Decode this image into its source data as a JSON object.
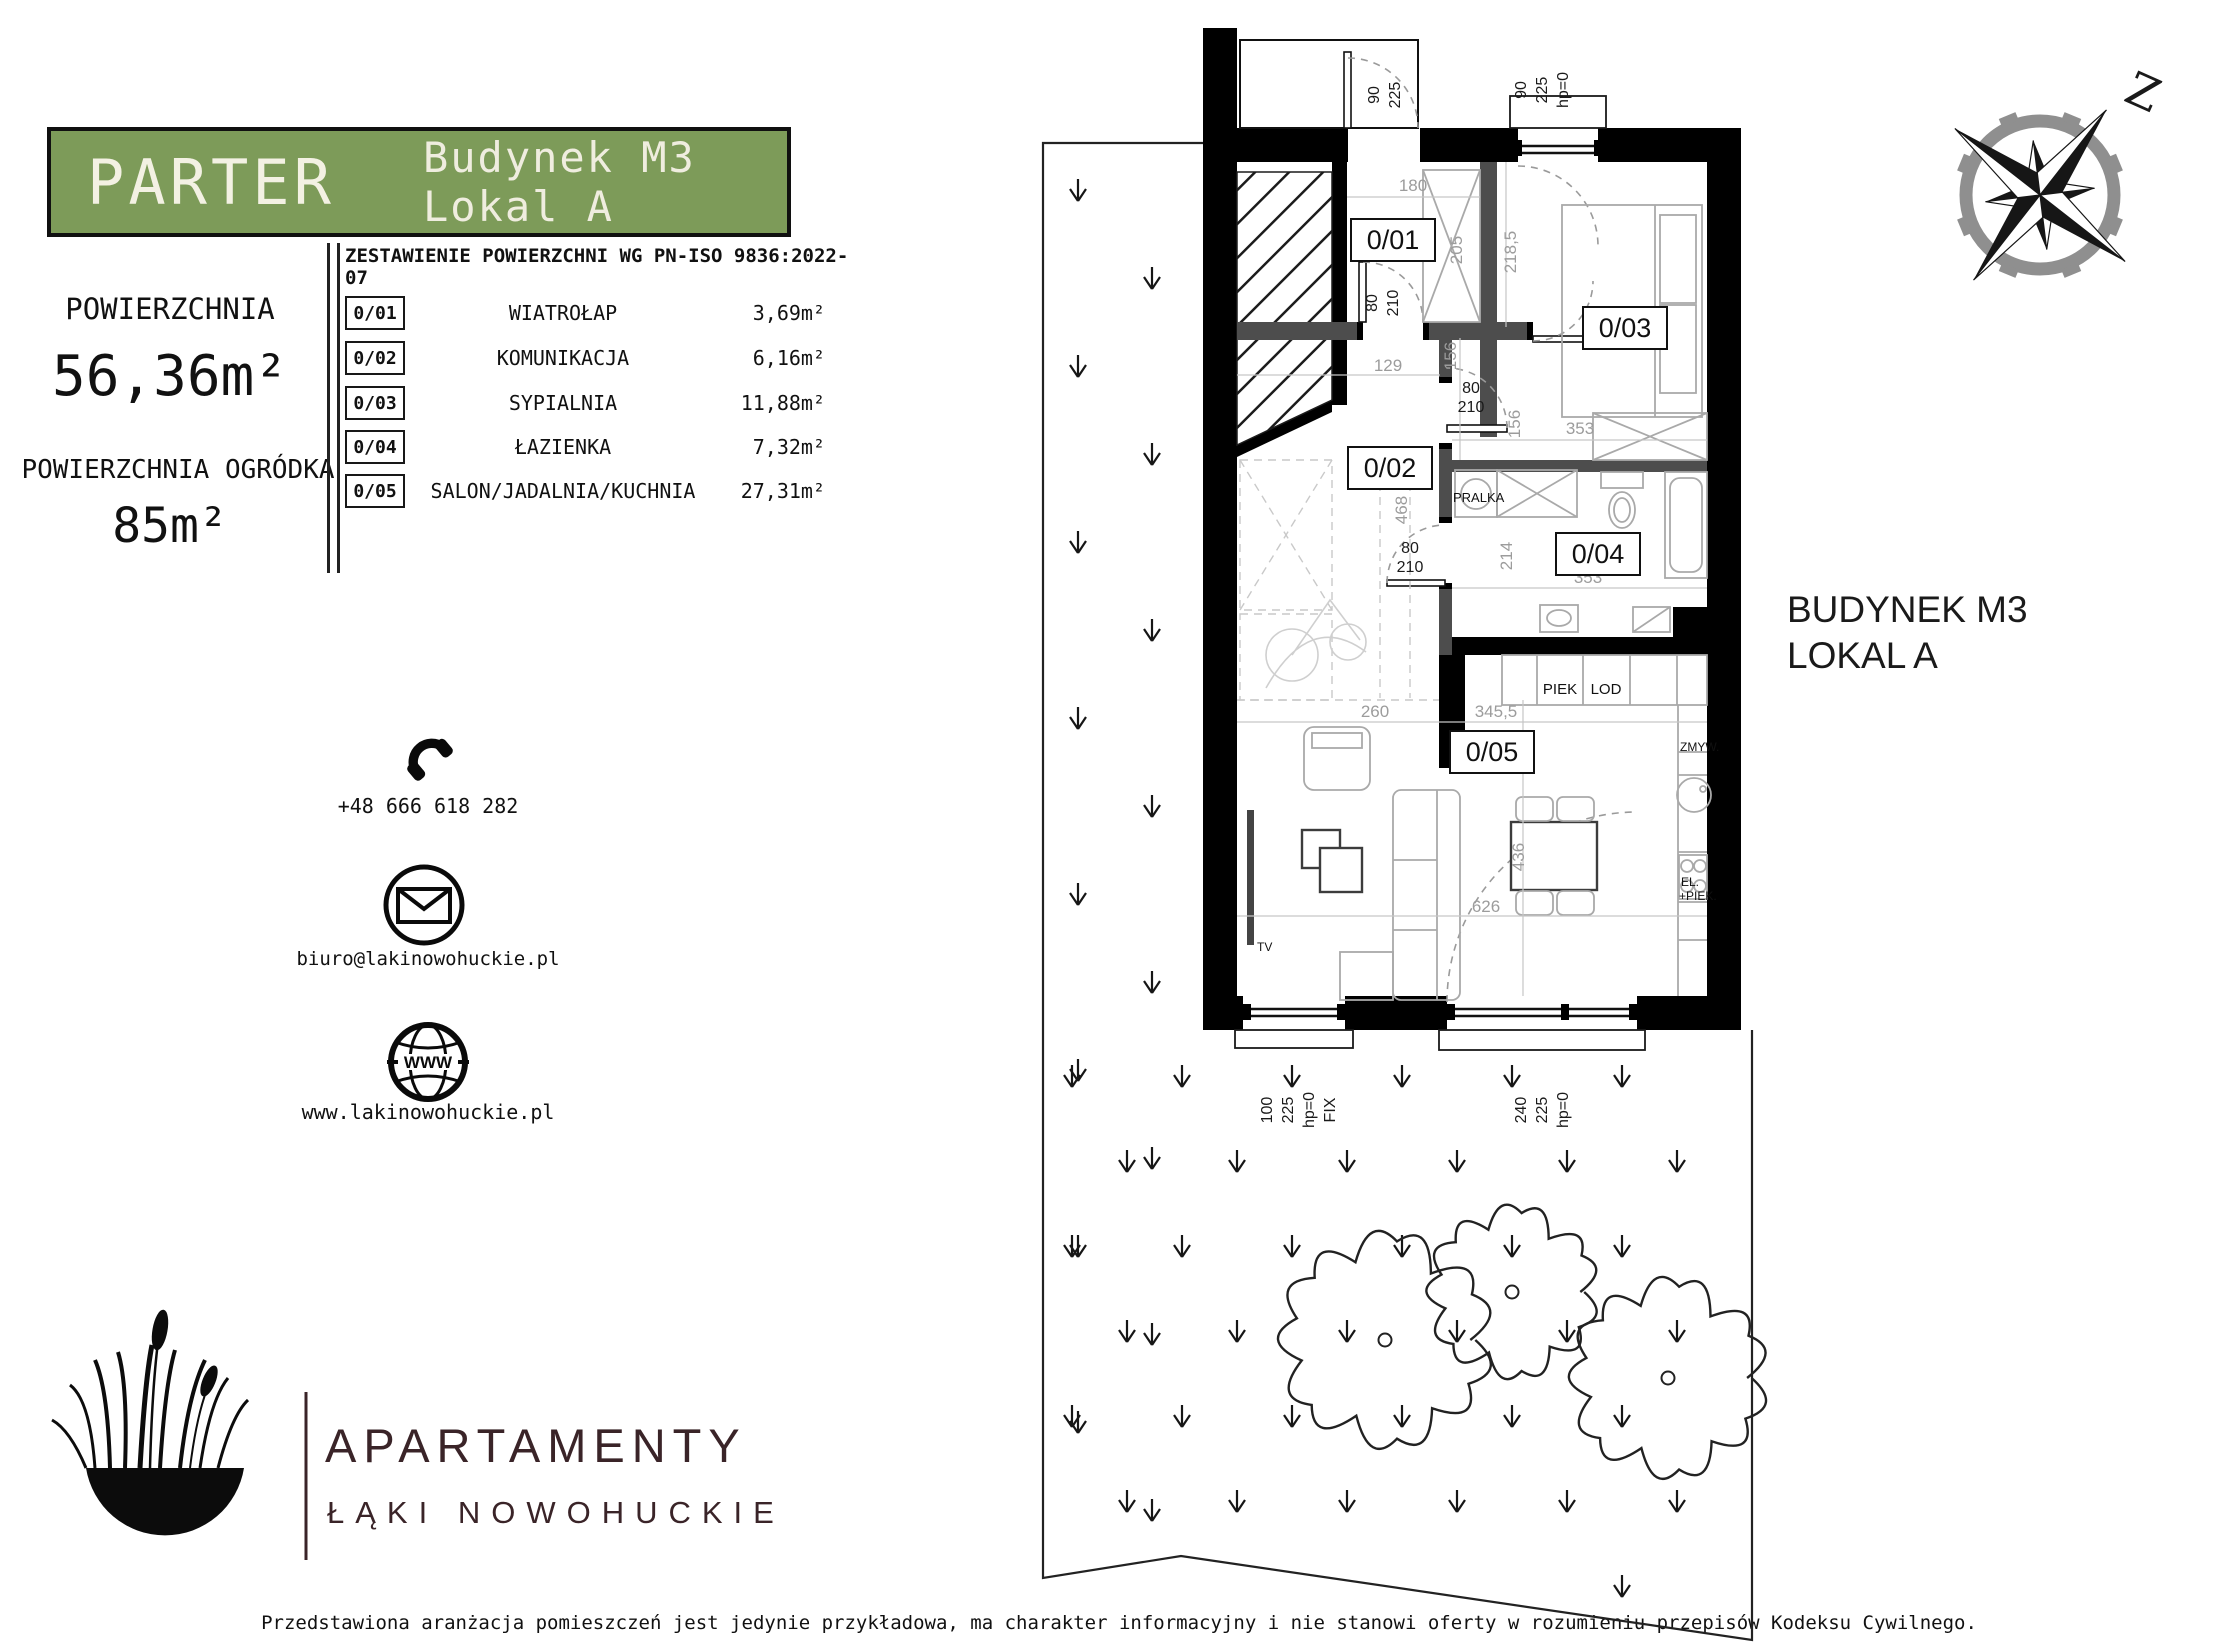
{
  "header": {
    "floor": "PARTER",
    "unit": "Budynek M3 Lokal A"
  },
  "area_panel": {
    "area_label": "POWIERZCHNIA",
    "area_value": "56,36m²",
    "garden_label": "POWIERZCHNIA OGRÓDKA",
    "garden_value": "85m²"
  },
  "table": {
    "title": "ZESTAWIENIE POWIERZCHNI WG PN-ISO 9836:2022-07",
    "rows": [
      {
        "code": "0/01",
        "name": "WIATROŁAP",
        "area": "3,69m²"
      },
      {
        "code": "0/02",
        "name": "KOMUNIKACJA",
        "area": "6,16m²"
      },
      {
        "code": "0/03",
        "name": "SYPIALNIA",
        "area": "11,88m²"
      },
      {
        "code": "0/04",
        "name": "ŁAZIENKA",
        "area": "7,32m²"
      },
      {
        "code": "0/05",
        "name": "SALON/JADALNIA/KUCHNIA",
        "area": "27,31m²"
      }
    ]
  },
  "contact": {
    "phone": "+48 666 618 282",
    "email": "biuro@lakinowohuckie.pl",
    "website": "www.lakinowohuckie.pl",
    "globe_label": "WWW"
  },
  "logo": {
    "line1": "APARTAMENTY",
    "line2": "ŁĄKI NOWOHUCKIE"
  },
  "plan": {
    "building_label": [
      "BUDYNEK M3",
      "LOKAL A"
    ],
    "compass_letter": "Z",
    "fixtures": {
      "pralka": "PRALKA",
      "piek": "PIEK",
      "lod": "LOD",
      "zmyw": "ZMYW.",
      "el1": "EL.",
      "el2": "+PIEK.",
      "tv": "TV"
    },
    "dims": {
      "d180": "180",
      "d129": "129",
      "d205": "205",
      "d218": "218,5",
      "d353_bed": "353",
      "d156a": "156",
      "d156b": "156",
      "d468": "468",
      "d214": "214",
      "d353_bath": "353",
      "d260": "260",
      "d345": "345,5",
      "d626": "626",
      "d436": "436"
    },
    "door_dim": [
      "80",
      "210"
    ],
    "win_top": [
      "90",
      "225"
    ],
    "win_top2": [
      "90",
      "225",
      "hp=0"
    ],
    "win_fix": [
      "100",
      "225",
      "hp=0",
      "FIX"
    ],
    "win_terrace": [
      "240",
      "225",
      "hp=0"
    ]
  },
  "disclaimer": "Przedstawiona aranżacja pomieszczeń jest jedynie przykładowa, ma charakter informacyjny i nie stanowi oferty w rozumieniu przepisów Kodeksu Cywilnego.",
  "colors": {
    "accent_green": "#7d9b59",
    "logo_maroon": "#3a2428",
    "wall_black": "#000000",
    "wall_gray": "#4d4d4d"
  }
}
